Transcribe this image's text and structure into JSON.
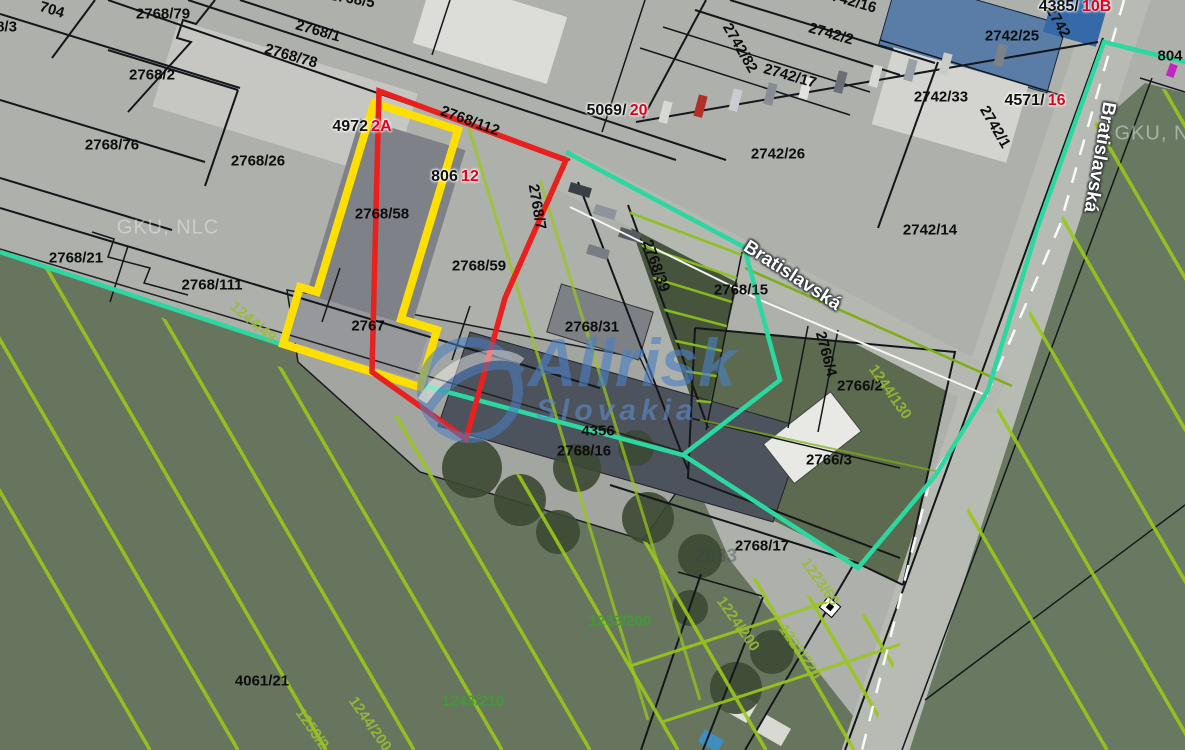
{
  "map": {
    "colors": {
      "selection_red": "#e8201e",
      "selection_yellow": "#ffdf00",
      "boundary_teal": "#2bd8a2",
      "hatch_green": "#9ac819",
      "label_green": "#3f9e35",
      "label_olive": "#97bd33",
      "label_red_suffix": "#e2001a",
      "watermark_blue": "#4b7fc4"
    },
    "parcel_labels": [
      {
        "text": "704",
        "x": 52,
        "y": 10,
        "rot": 17,
        "cls": ""
      },
      {
        "text": "2768/3",
        "x": -6,
        "y": 27,
        "rot": 0,
        "cls": ""
      },
      {
        "text": "2768/79",
        "x": 163,
        "y": 14,
        "rot": 0,
        "cls": ""
      },
      {
        "text": "2768/5",
        "x": 352,
        "y": -1,
        "rot": 10,
        "cls": ""
      },
      {
        "text": "2768/1",
        "x": 318,
        "y": 31,
        "rot": 16,
        "cls": ""
      },
      {
        "text": "2768/78",
        "x": 291,
        "y": 56,
        "rot": 16,
        "cls": ""
      },
      {
        "text": "2768/2",
        "x": 152,
        "y": 75,
        "rot": 0,
        "cls": ""
      },
      {
        "text": "2768/76",
        "x": 112,
        "y": 145,
        "rot": 0,
        "cls": ""
      },
      {
        "text": "2768/26",
        "x": 258,
        "y": 161,
        "rot": 0,
        "cls": ""
      },
      {
        "text": "2768/112",
        "x": 470,
        "y": 121,
        "rot": 20,
        "cls": ""
      },
      {
        "text": "2768/111",
        "x": 212,
        "y": 285,
        "rot": 0,
        "cls": ""
      },
      {
        "text": "2768/21",
        "x": 76,
        "y": 258,
        "rot": 0,
        "cls": ""
      },
      {
        "text": "2768/58",
        "x": 382,
        "y": 214,
        "rot": 0,
        "cls": ""
      },
      {
        "text": "2768/59",
        "x": 479,
        "y": 266,
        "rot": 0,
        "cls": ""
      },
      {
        "text": "2767",
        "x": 368,
        "y": 326,
        "rot": 0,
        "cls": ""
      },
      {
        "text": "2768/7",
        "x": 537,
        "y": 207,
        "rot": 80,
        "cls": ""
      },
      {
        "text": "2768/39",
        "x": 656,
        "y": 266,
        "rot": 70,
        "cls": ""
      },
      {
        "text": "2768/15",
        "x": 741,
        "y": 290,
        "rot": 0,
        "cls": ""
      },
      {
        "text": "2768/31",
        "x": 592,
        "y": 327,
        "rot": 0,
        "cls": ""
      },
      {
        "text": "4356",
        "x": 598,
        "y": 431,
        "rot": 0,
        "cls": ""
      },
      {
        "text": "2768/16",
        "x": 584,
        "y": 451,
        "rot": 0,
        "cls": ""
      },
      {
        "text": "2768/17",
        "x": 762,
        "y": 546,
        "rot": 0,
        "cls": ""
      },
      {
        "text": "2766/2",
        "x": 860,
        "y": 386,
        "rot": 0,
        "cls": ""
      },
      {
        "text": "2766/4",
        "x": 826,
        "y": 354,
        "rot": 75,
        "cls": ""
      },
      {
        "text": "2766/3",
        "x": 829,
        "y": 460,
        "rot": 0,
        "cls": ""
      },
      {
        "text": "2742/2",
        "x": 831,
        "y": 34,
        "rot": 16,
        "cls": ""
      },
      {
        "text": "2742/17",
        "x": 790,
        "y": 76,
        "rot": 16,
        "cls": ""
      },
      {
        "text": "2742/16",
        "x": 850,
        "y": 1,
        "rot": 16,
        "cls": ""
      },
      {
        "text": "2742/82",
        "x": 740,
        "y": 48,
        "rot": 60,
        "cls": ""
      },
      {
        "text": "2742/26",
        "x": 778,
        "y": 154,
        "rot": 0,
        "cls": ""
      },
      {
        "text": "2742/14",
        "x": 930,
        "y": 230,
        "rot": 0,
        "cls": ""
      },
      {
        "text": "2742/33",
        "x": 941,
        "y": 97,
        "rot": 0,
        "cls": ""
      },
      {
        "text": "2742/25",
        "x": 1012,
        "y": 36,
        "rot": 0,
        "cls": ""
      },
      {
        "text": "2742",
        "x": 1058,
        "y": 22,
        "rot": 60,
        "cls": ""
      },
      {
        "text": "2742/1",
        "x": 995,
        "y": 127,
        "rot": 60,
        "cls": ""
      },
      {
        "text": "804",
        "x": 1170,
        "y": 56,
        "rot": 0,
        "cls": ""
      },
      {
        "text": "4061/21",
        "x": 262,
        "y": 681,
        "rot": 0,
        "cls": ""
      },
      {
        "text": "1233/200",
        "x": 620,
        "y": 621,
        "rot": 0,
        "cls": "green"
      },
      {
        "text": "1243/210",
        "x": 473,
        "y": 701,
        "rot": 0,
        "cls": "green"
      },
      {
        "text": "1244/49",
        "x": 253,
        "y": 322,
        "rot": 40,
        "cls": "olive"
      },
      {
        "text": "1244/130",
        "x": 890,
        "y": 392,
        "rot": 55,
        "cls": "olive"
      },
      {
        "text": "1223/60",
        "x": 820,
        "y": 582,
        "rot": 55,
        "cls": "olive"
      },
      {
        "text": "1224/200",
        "x": 738,
        "y": 624,
        "rot": 55,
        "cls": "olive"
      },
      {
        "text": "1223/220",
        "x": 800,
        "y": 652,
        "rot": 55,
        "cls": "olive"
      },
      {
        "text": "1244/200",
        "x": 370,
        "y": 724,
        "rot": 55,
        "cls": "olive"
      },
      {
        "text": "1253/2",
        "x": 312,
        "y": 729,
        "rot": 55,
        "cls": "olive"
      },
      {
        "text": "2033",
        "x": 716,
        "y": 557,
        "rot": 0,
        "cls": "faint"
      }
    ],
    "highlight_labels": [
      {
        "prefix": "4972",
        "suffix": "2A",
        "x": 362,
        "y": 127
      },
      {
        "prefix": "806",
        "suffix": "12",
        "x": 455,
        "y": 177
      },
      {
        "prefix": "5069/",
        "suffix": "20",
        "x": 617,
        "y": 111
      },
      {
        "prefix": "4571/",
        "suffix": "16",
        "x": 1035,
        "y": 101
      },
      {
        "prefix": "4385/",
        "suffix": "10B",
        "x": 1075,
        "y": 7
      }
    ],
    "street_labels": [
      {
        "text": "Bratislavská",
        "x": 792,
        "y": 276,
        "rot": 33
      },
      {
        "text": "Bratislavská",
        "x": 1099,
        "y": 157,
        "rot": 100
      }
    ],
    "watermarks": {
      "gku_left": "GKU, NLC",
      "gku_right": "GKU, NL",
      "allrisk_title": "Allrisk",
      "allrisk_subtitle": "Slovakia"
    }
  }
}
